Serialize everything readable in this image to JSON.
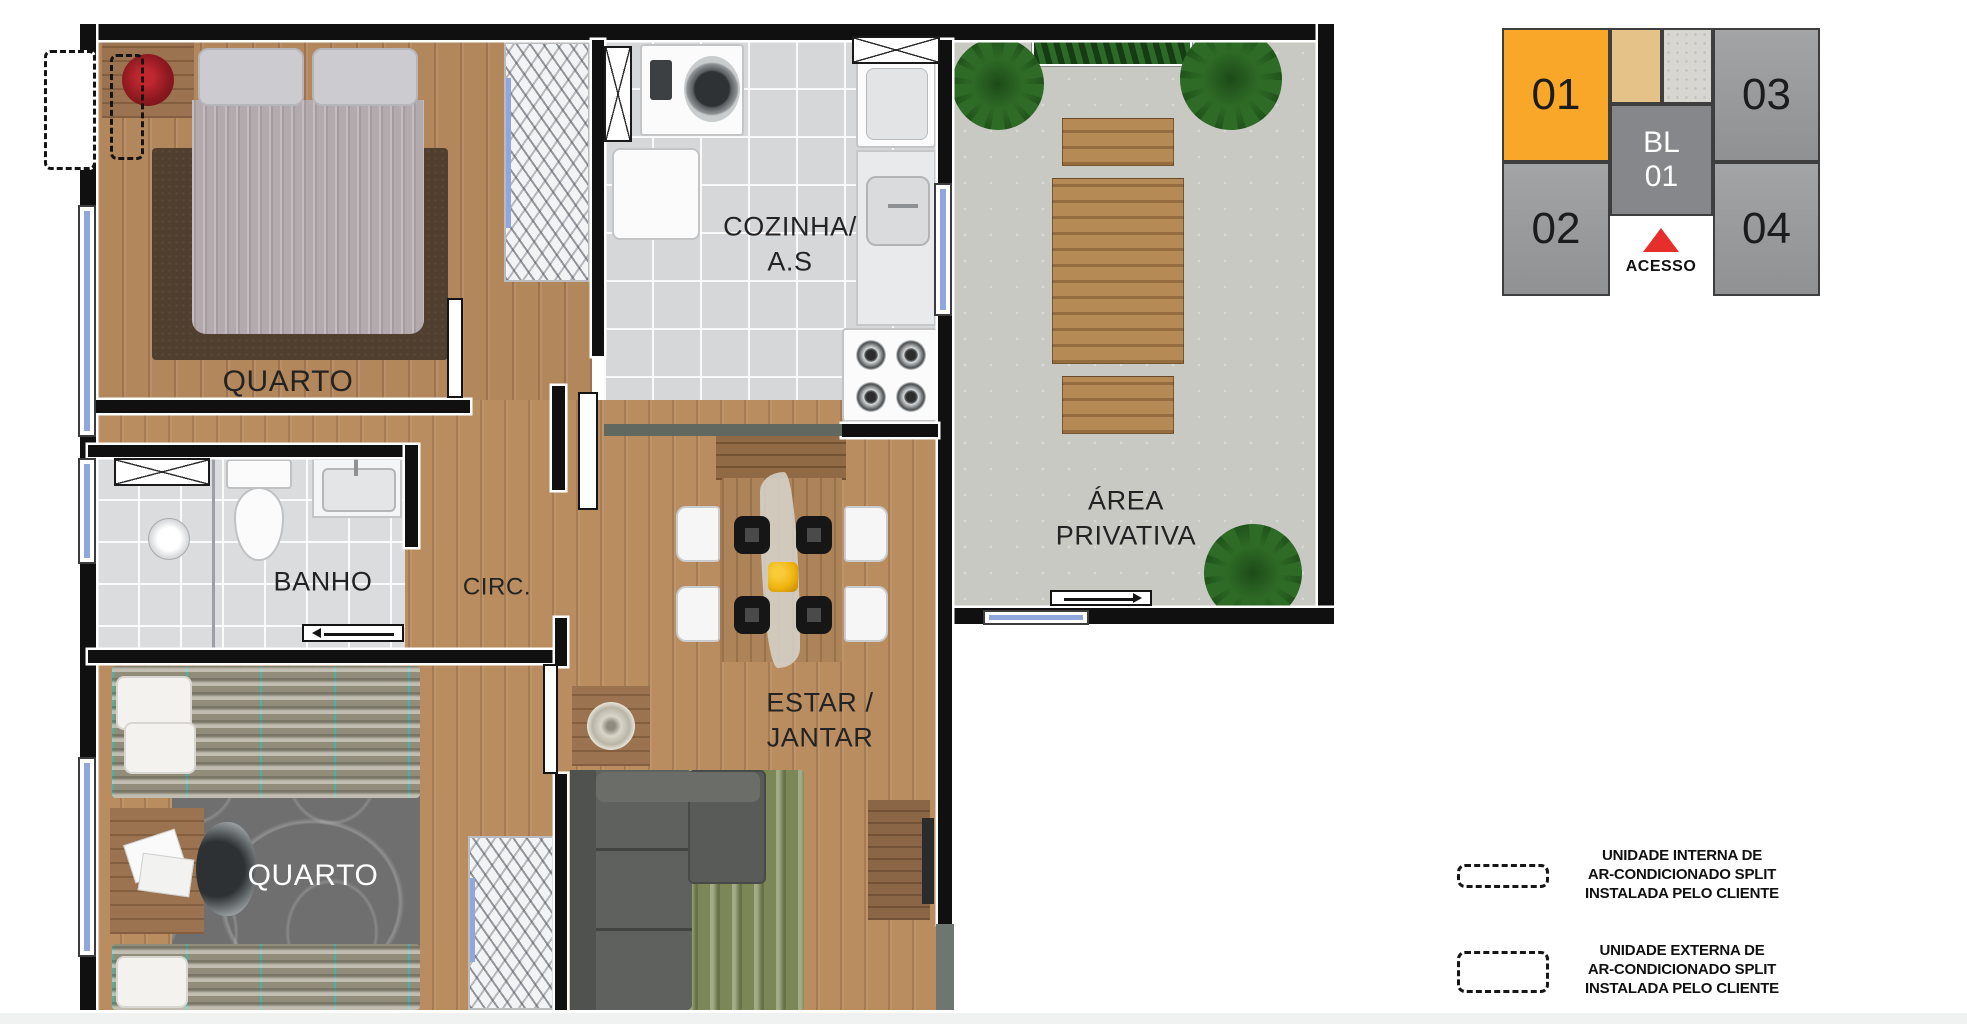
{
  "plan": {
    "rooms": {
      "quarto1": "QUARTO",
      "cozinha_line1": "COZINHA/",
      "cozinha_line2": "A.S",
      "area_line1": "ÁREA",
      "area_line2": "PRIVATIVA",
      "banho": "BANHO",
      "circ": "CIRC.",
      "estar_line1": "ESTAR /",
      "estar_line2": "JANTAR",
      "quarto2": "QUARTO"
    },
    "colors": {
      "wood_floor": "#B3875C",
      "tile_floor": "#D5D7D9",
      "concrete_floor": "#C9C9C4",
      "wall": "#101010",
      "window_glass": "#8FA7DB"
    }
  },
  "key_plan": {
    "units": {
      "u1": "01",
      "u2": "02",
      "u3": "03",
      "u4": "04"
    },
    "block_line1": "BL",
    "block_line2": "01",
    "access": "ACESSO",
    "colors": {
      "highlighted_unit": "#F9A728",
      "unit_gray": "#97999B",
      "block_gray": "#85878A",
      "access_marker_red": "#E62E2A",
      "tan_cell": "#E5C287",
      "concrete_cell": "#D7D6D1"
    }
  },
  "legend": {
    "internal": {
      "line1": "UNIDADE INTERNA DE",
      "line2": "AR-CONDICIONADO SPLIT",
      "line3": "INSTALADA PELO CLIENTE"
    },
    "external": {
      "line1": "UNIDADE EXTERNA DE",
      "line2": "AR-CONDICIONADO SPLIT",
      "line3": "INSTALADA PELO CLIENTE"
    }
  }
}
